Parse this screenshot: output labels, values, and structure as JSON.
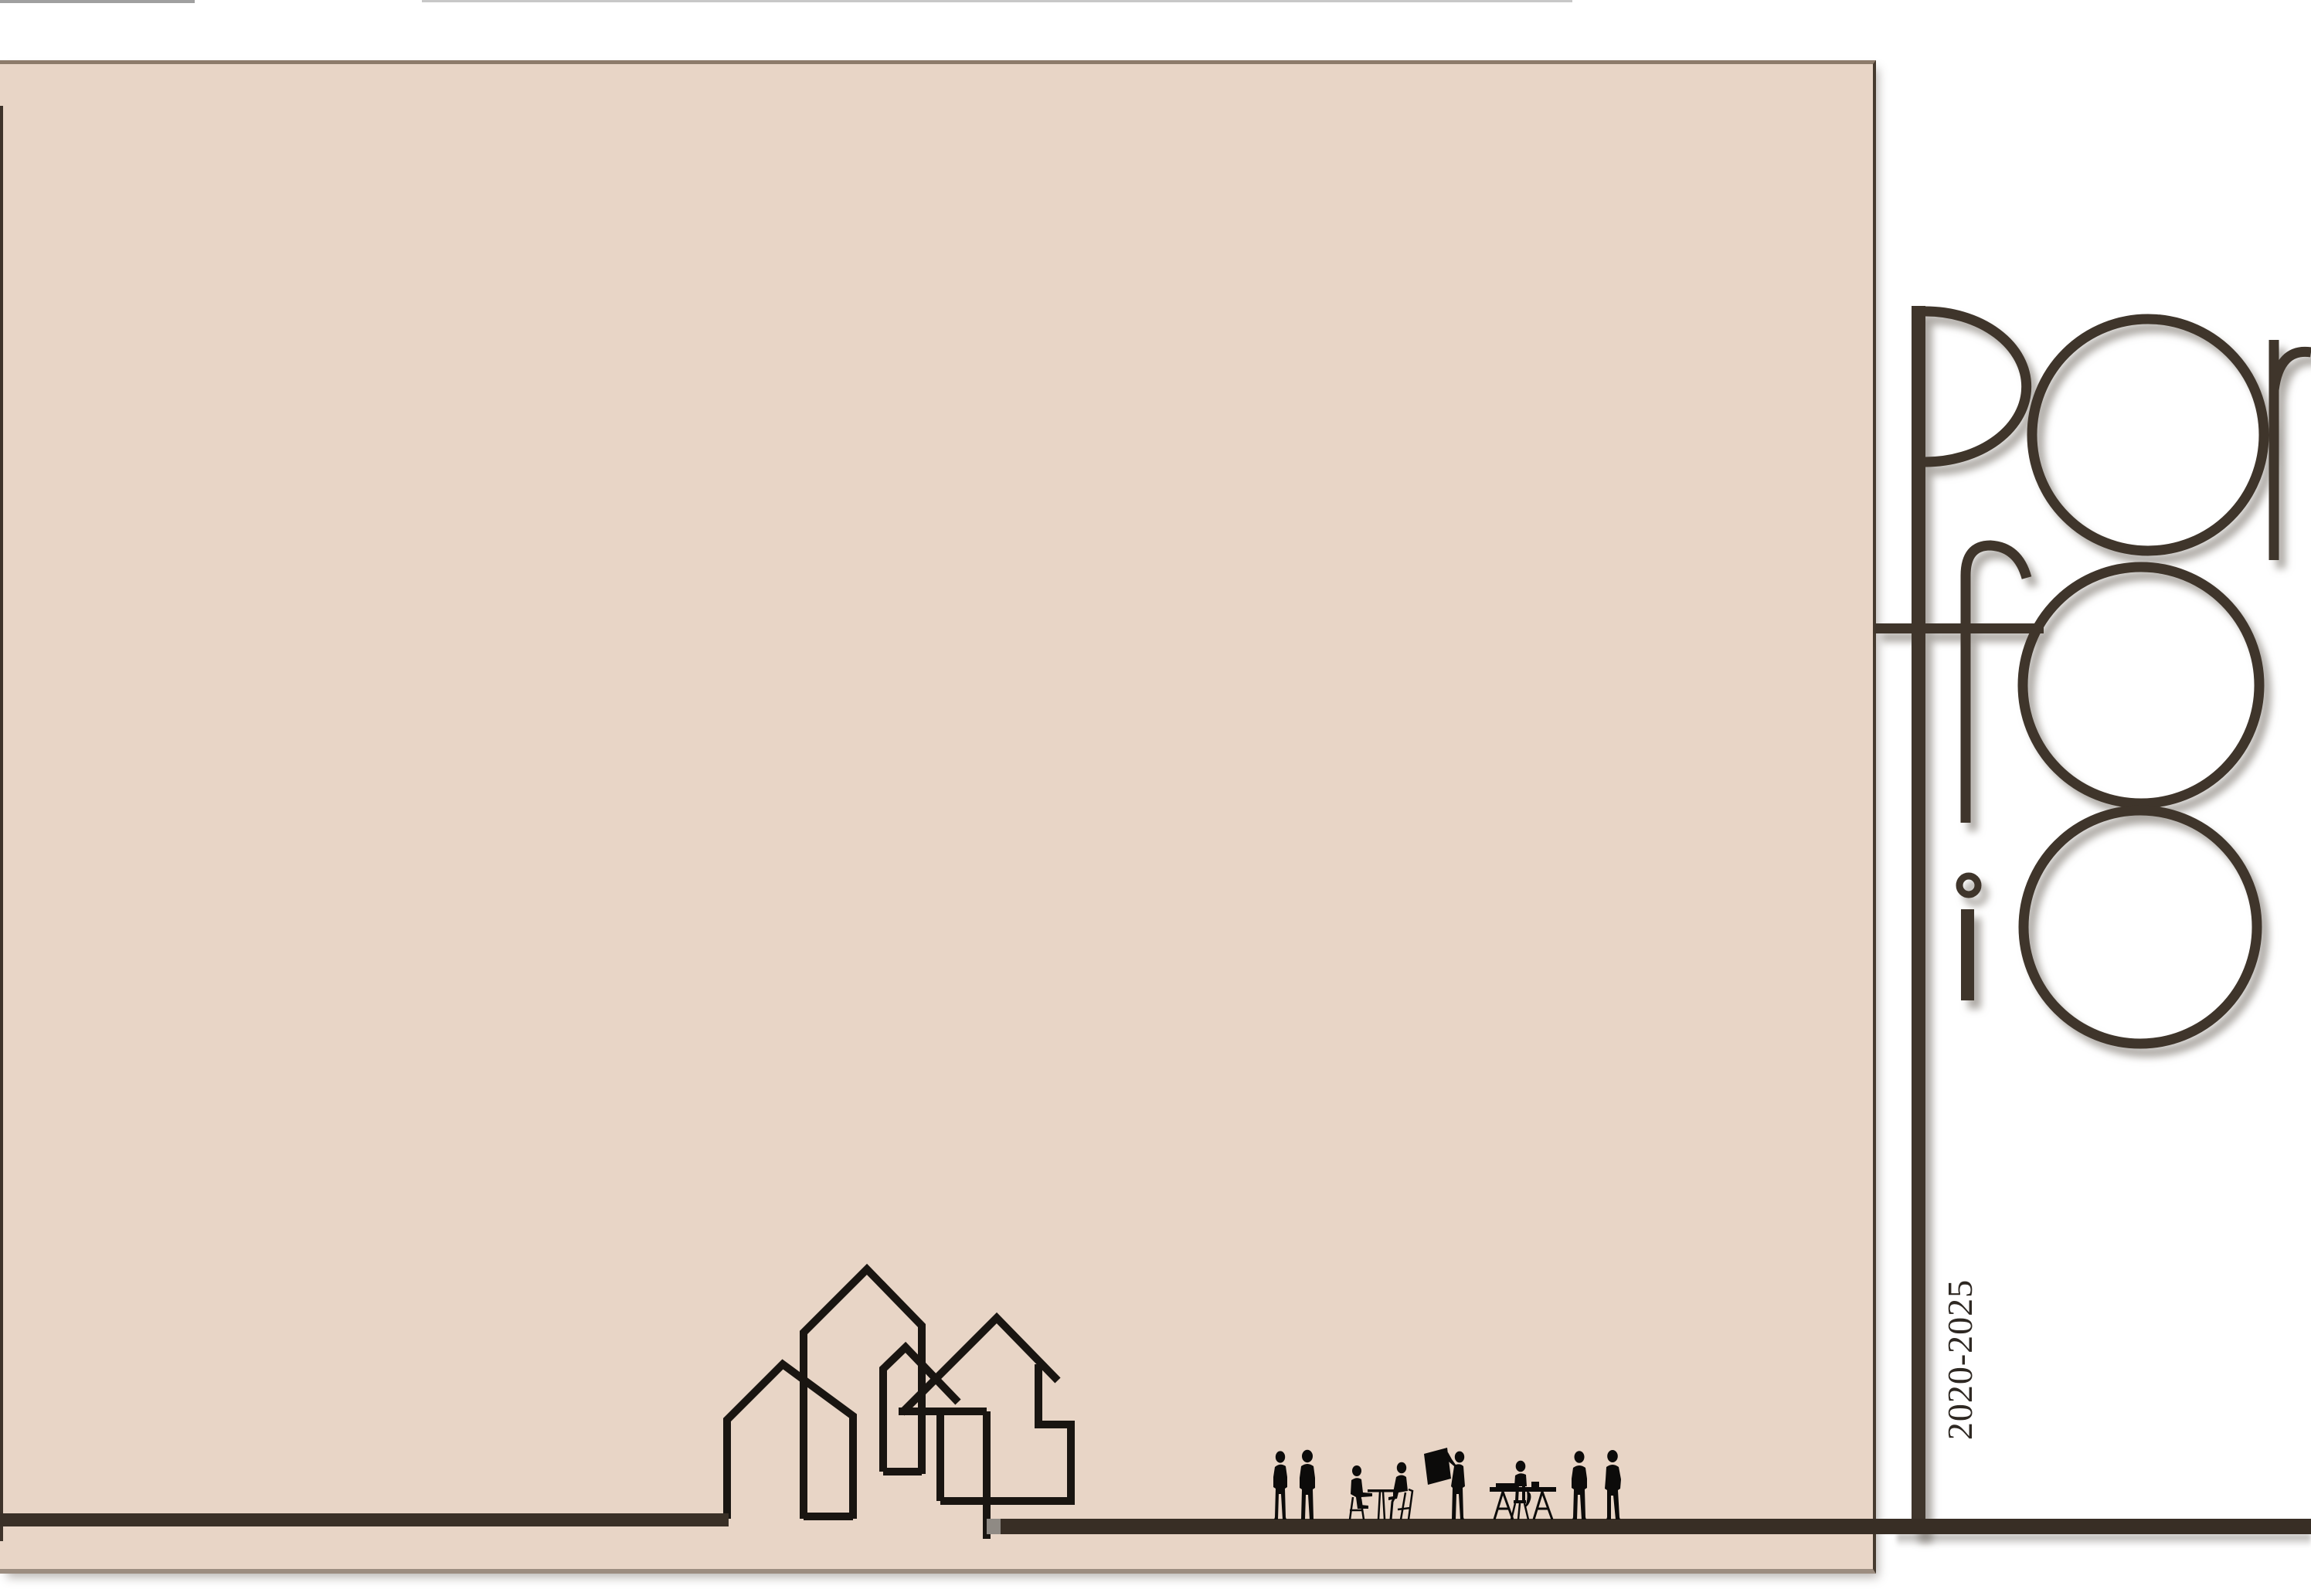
{
  "document": {
    "kind": "architecture portfolio cover page",
    "background": "white with large beige panel"
  },
  "wordmark": {
    "text": "Portfolio",
    "rows": [
      "Por",
      "tfo",
      "lio"
    ],
    "style": "thin geometric outline letters with stacked circles and full-height stem"
  },
  "years_label": "2020-2025",
  "artwork": {
    "houses_count": 5,
    "houses_style": "continuous single-line house outlines, interlocked",
    "people_summary": "silhouettes of people: two standing, two seated at a small table, one holding up a drawing board, one seated at a trestle drafting table, two standing",
    "people": [
      "standing-man",
      "standing-man",
      "two-seated-at-table",
      "man-holding-drawing-board",
      "drafter-at-trestle-table",
      "standing-man",
      "standing-man"
    ]
  },
  "palette": {
    "panel_beige": "#e8d5c6",
    "ink_brown": "#3f352b",
    "baseline_bar": "#382e25",
    "house_line": "#191511",
    "silhouette_black": "#0c0b0a",
    "panel_border_top": "#8d7b6b",
    "panel_border_right": "#463a2e",
    "panel_border_bottom": "#9c8d80",
    "shadow_gray": "#b9b5b0"
  }
}
